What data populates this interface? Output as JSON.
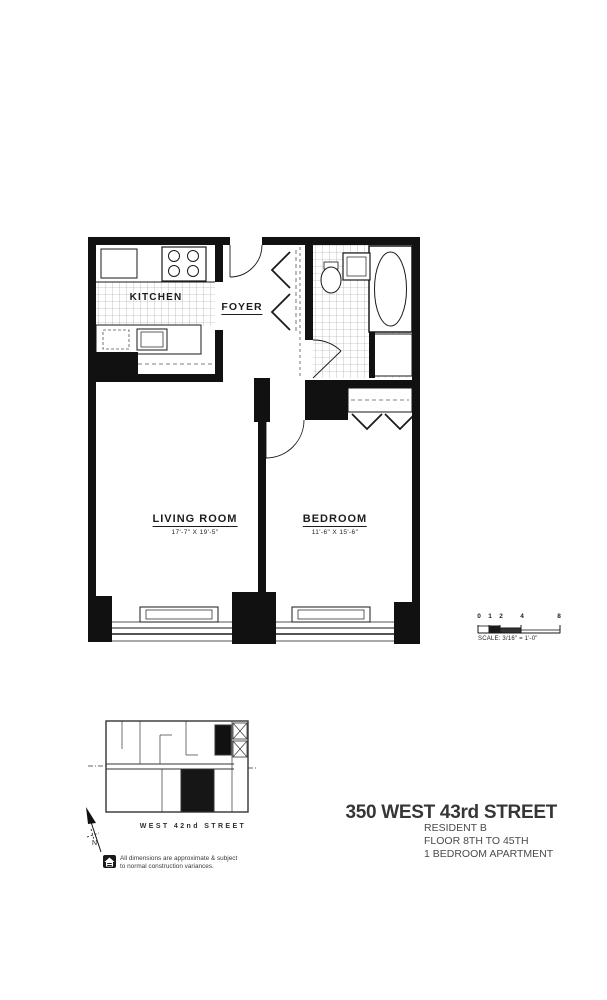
{
  "title_block": {
    "building": "350 WEST 43rd STREET",
    "resident": "RESIDENT B",
    "floor_range": "FLOOR 8TH TO 45TH",
    "apartment_type": "1 BEDROOM APARTMENT"
  },
  "floor_plan": {
    "kitchen_label": "KITCHEN",
    "foyer_label": "FOYER",
    "living_room_label": "LIVING ROOM",
    "living_room_dimensions": "17'-7\" X 19'-5\"",
    "bedroom_label": "BEDROOM",
    "bedroom_dimensions": "11'-6\" X 15'-6\""
  },
  "scale_bar": {
    "ticks": [
      "0",
      "1",
      "2",
      "4",
      "8"
    ],
    "label": "SCALE: 3/16\" = 1'-0\""
  },
  "key_plan": {
    "street_label": "WEST 42nd STREET",
    "north_label": "N"
  },
  "disclaimer": {
    "line1": "All dimensions are approximate & subject",
    "line2": "to normal construction variances."
  },
  "icons": {
    "equal_housing": "equal-housing-logo",
    "north_arrow": "north-arrow"
  },
  "colors": {
    "ink": "#1a1a1a",
    "tile_line": "#9a9a9a",
    "title_text": "#363636",
    "body_text": "#4a4a4a"
  }
}
